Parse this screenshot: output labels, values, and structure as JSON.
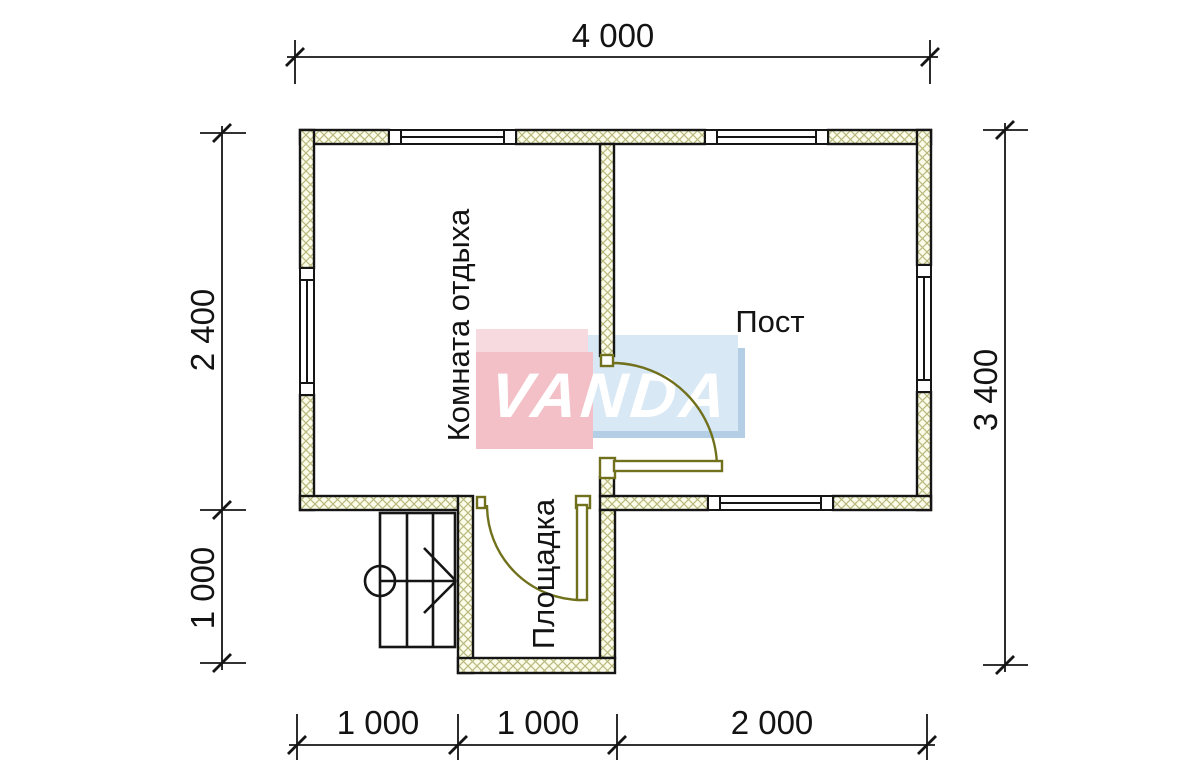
{
  "drawing": {
    "type": "floor-plan",
    "watermark": {
      "text": "VANDA"
    },
    "rooms": [
      {
        "id": "rest-room",
        "label": "Комната отдыха"
      },
      {
        "id": "post-room",
        "label": "Пост"
      },
      {
        "id": "landing",
        "label": "Площадка"
      }
    ],
    "dimensions": {
      "top": [
        {
          "label": "4 000",
          "side": "top"
        }
      ],
      "left": [
        {
          "label": "2 400",
          "side": "left"
        },
        {
          "label": "1 000",
          "side": "left"
        }
      ],
      "right": [
        {
          "label": "3 400",
          "side": "right"
        }
      ],
      "bottom": [
        {
          "label": "1 000",
          "side": "bottom"
        },
        {
          "label": "1 000",
          "side": "bottom"
        },
        {
          "label": "2 000",
          "side": "bottom"
        }
      ]
    },
    "colors": {
      "background": "#ffffff",
      "wall_fill": "#fcfcea",
      "wall_hatch": "#b9b97e",
      "line": "#151515",
      "door": "#71711d",
      "logo_blue_light": "#d8e8f5",
      "logo_blue_dark": "#b4cfe5",
      "logo_pink": "#f3c0c8",
      "logo_pink_light": "#f7dae0",
      "logo_text": "#ffffff"
    },
    "symbols": [
      {
        "name": "stairs",
        "treads": 3
      },
      {
        "name": "stair-direction-arrow"
      },
      {
        "name": "interior-door-swing"
      },
      {
        "name": "entrance-door-swing"
      },
      {
        "count_windows": 5
      }
    ]
  }
}
